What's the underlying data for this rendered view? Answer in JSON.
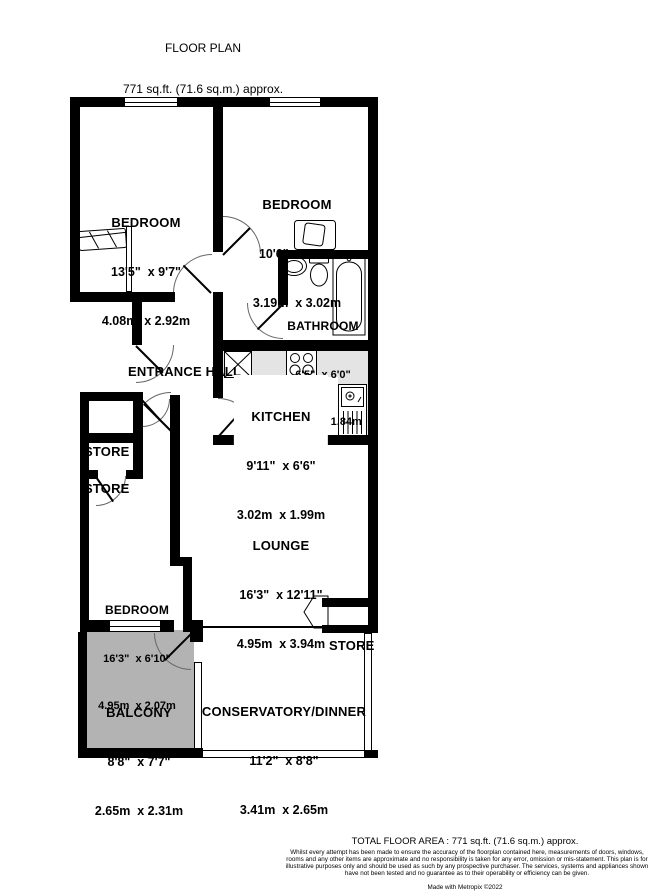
{
  "title": {
    "heading": "FLOOR PLAN",
    "subheading": "771 sq.ft. (71.6 sq.m.) approx."
  },
  "rooms": {
    "bedroom1": {
      "name": "BEDROOM",
      "imperial": "13'5\"  x 9'7\"",
      "metric": "4.08m  x 2.92m"
    },
    "bedroom2": {
      "name": "BEDROOM",
      "imperial": "10'6\"  x 9'11\"",
      "metric": "3.19m  x 3.02m"
    },
    "bathroom": {
      "name": "BATHROOM",
      "imperial": "6'5\"  x 6'0\"",
      "metric": "1.96m  x 1.84m"
    },
    "entrance_hall": {
      "name": "ENTRANCE HALL"
    },
    "kitchen": {
      "name": "KITCHEN",
      "imperial": "9'11\"  x 6'6\"",
      "metric": "3.02m  x 1.99m"
    },
    "store1": {
      "name": "STORE"
    },
    "store2": {
      "name": "STORE"
    },
    "lounge": {
      "name": "LOUNGE",
      "imperial": "16'3\"  x 12'11\"",
      "metric": "4.95m  x 3.94m"
    },
    "bedroom3": {
      "name": "BEDROOM",
      "imperial": "16'3\"  x 6'10\"",
      "metric": "4.95m  x 2.07m"
    },
    "store3": {
      "name": "STORE"
    },
    "balcony": {
      "name": "BALCONY",
      "imperial": "8'8\"  x 7'7\"",
      "metric": "2.65m  x 2.31m"
    },
    "conservatory": {
      "name": "CONSERVATORY/DINNER",
      "imperial": "11'2\"  x 8'8\"",
      "metric": "3.41m  x 2.65m"
    }
  },
  "footer": {
    "total_area": "TOTAL FLOOR AREA : 771 sq.ft. (71.6 sq.m.) approx.",
    "disclaimer": "Whilst every attempt has been made to ensure the accuracy of the floorplan contained here, measurements of doors, windows, rooms and any other items are approximate and no responsibility is taken for any error, omission or mis-statement. This plan is for illustrative purposes only and should be used as such by any prospective purchaser. The services, systems and appliances shown have not been tested and no guarantee as to their operability or efficiency can be given.",
    "credit": "Made with Metropix ©2022"
  },
  "colors": {
    "wall": "#000000",
    "balcony_fill": "#b3b3b3",
    "counter_fill": "#e4e4e4"
  }
}
